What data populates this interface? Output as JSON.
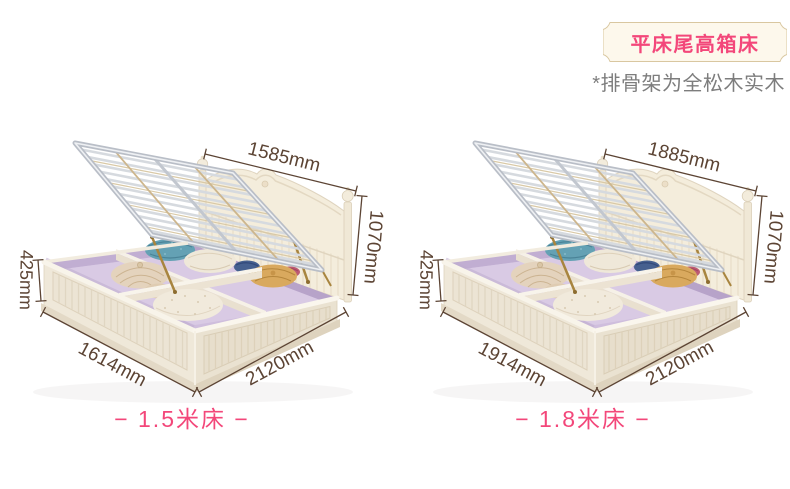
{
  "page": {
    "background": "#ffffff"
  },
  "badge": {
    "label": "平床尾高箱床"
  },
  "note": {
    "text": "*排骨架为全松木实木"
  },
  "beds": [
    {
      "id": "1.5m",
      "size_label": "− 1.5米床 −",
      "dims": {
        "slat_frame_width": "1585mm",
        "total_height": "1070mm",
        "box_height": "425mm",
        "bed_width": "1614mm",
        "bed_length": "2120mm"
      }
    },
    {
      "id": "1.8m",
      "size_label": "− 1.8米床 −",
      "dims": {
        "slat_frame_width": "1885mm",
        "total_height": "1070mm",
        "box_height": "425mm",
        "bed_width": "1914mm",
        "bed_length": "2120mm"
      }
    }
  ],
  "colors": {
    "accent_pink": "#f3477a",
    "dimension_text": "#5c4434",
    "badge_bg": "#fdf8ec",
    "badge_border": "#d9c7a0",
    "note_gray": "#7d7d7d",
    "bed_cream": "#efe8d9",
    "interior_lavender": "#cfbedd",
    "slat_metal": "#c6cbd2",
    "strut_gold": "#a8853f"
  }
}
